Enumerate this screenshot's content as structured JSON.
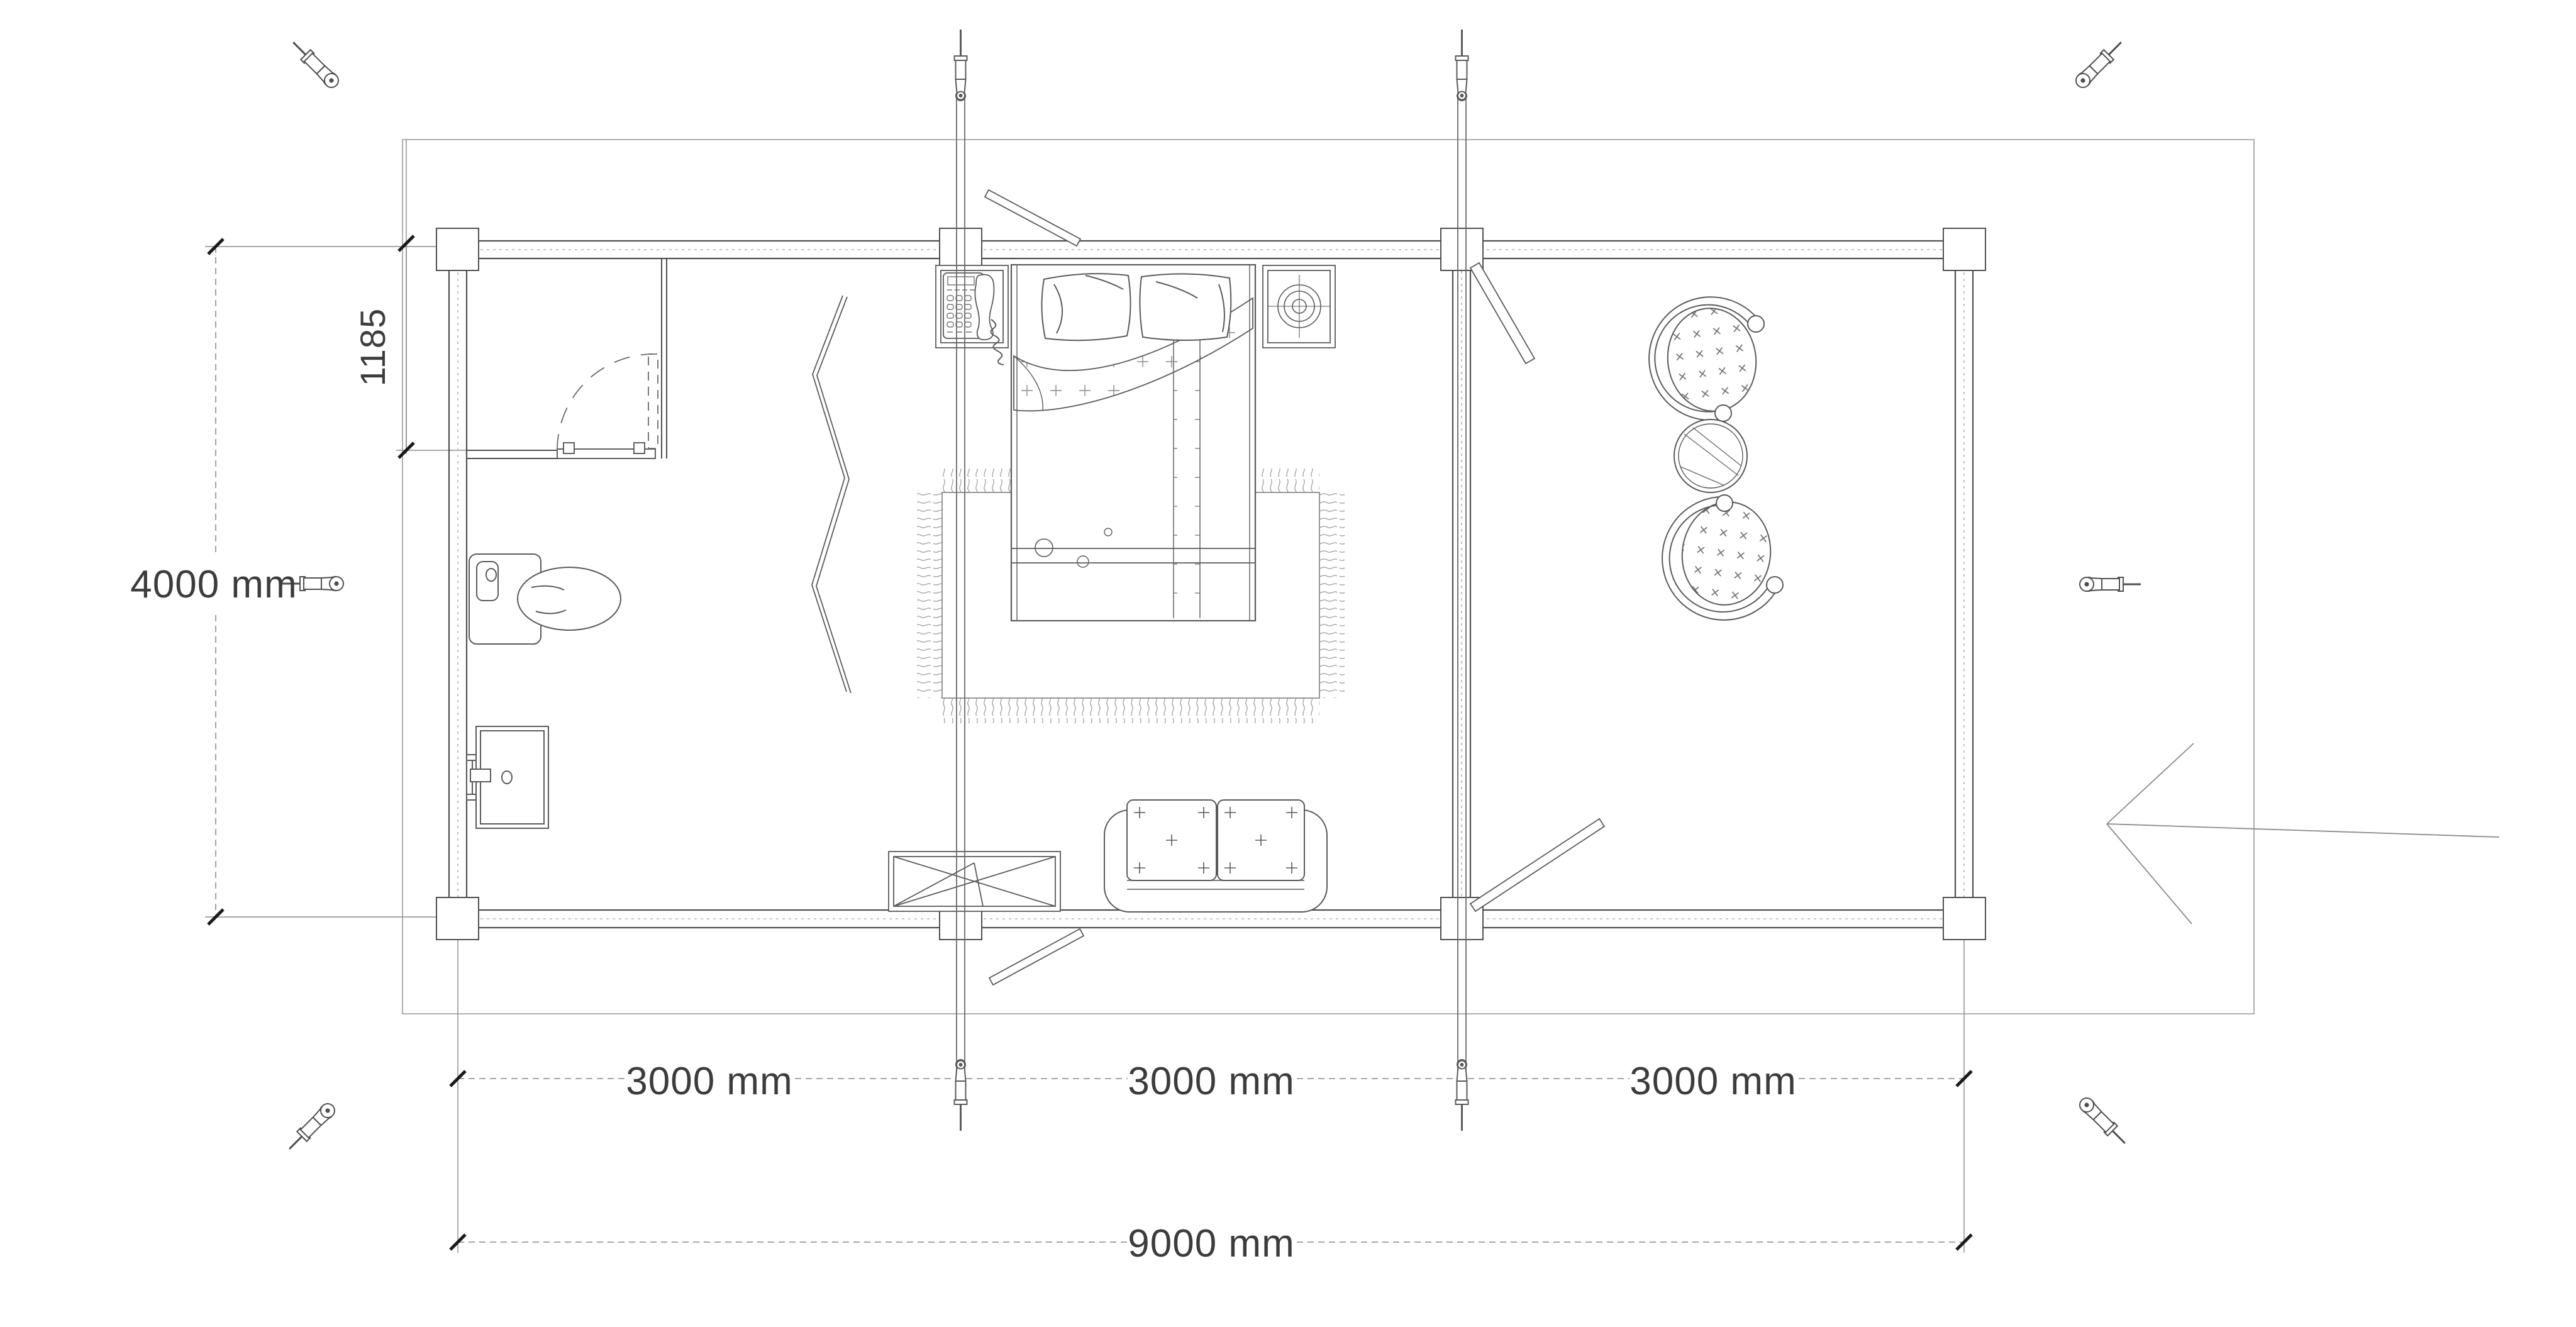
{
  "drawing": {
    "type": "floor-plan",
    "dimensions": {
      "bay1": "3000 mm",
      "bay2": "3000 mm",
      "bay3": "3000 mm",
      "total_width": "9000 mm",
      "depth": "4000 mm",
      "closet_depth": "1185"
    },
    "colors": {
      "ink": "#4f4f4f",
      "light_ink": "#8c8c8c",
      "joint": "#b0b0b0",
      "text": "#3c3c3c",
      "tick": "#1a1a1a",
      "background": "#ffffff"
    },
    "symbols": {
      "fasteners": "turnbuckle-screw-icon",
      "rods": "tie-rod-with-turnbuckle",
      "furniture": [
        "bed",
        "pillows",
        "rug",
        "telephone",
        "nightstands",
        "speaker",
        "toilet",
        "sink",
        "sofa",
        "folding-table",
        "armchairs",
        "round-table",
        "zigzag-partition"
      ],
      "annotations": [
        "dimension-lines",
        "entrance-arrow",
        "door-swings"
      ]
    }
  }
}
